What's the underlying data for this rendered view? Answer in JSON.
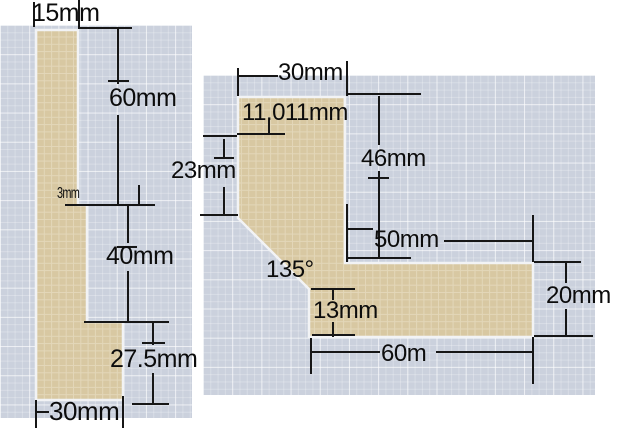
{
  "colors": {
    "page_background": "#ffffff",
    "grid_panel_background": "#cbd1dd",
    "grid_line": "#dde1ea",
    "shape_fill": "#d8c8a2",
    "shape_outline": "#f2f3f5",
    "dimension_line": "#161616",
    "dimension_text": "#0c0c0c"
  },
  "panels": {
    "left": {
      "labels": {
        "width_top": "15mm",
        "height_upper": "60mm",
        "step": "3mm",
        "height_middle": "40mm",
        "height_lower": "27.5mm",
        "width_bottom": "30mm"
      }
    },
    "right": {
      "labels": {
        "width_top": "30mm",
        "chamfer_len": "11.011mm",
        "height_left": "23mm",
        "height_right": "46mm",
        "arm_top_len": "50mm",
        "chamfer_angle": "135°",
        "notch_height": "13mm",
        "arm_thickness": "20mm",
        "arm_bottom_len": "60m"
      }
    }
  }
}
